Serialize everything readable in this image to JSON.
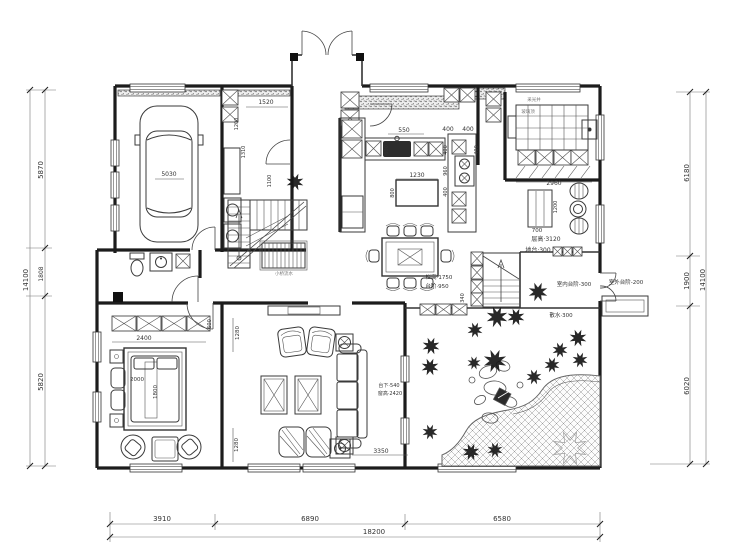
{
  "title": "住宅一层平面布置图",
  "dims": {
    "left": {
      "total": "14100",
      "segments": [
        "5870",
        "1808",
        "5820"
      ]
    },
    "right": {
      "total": "14100",
      "segments": [
        "6180",
        "1900",
        "6020"
      ]
    },
    "bottom": {
      "total": "18200",
      "segments": [
        "3910",
        "6890",
        "6580"
      ]
    }
  },
  "labels": {
    "dim_5870": "5870",
    "dim_1808": "1808",
    "dim_5820": "5820",
    "dim_14100_left": "14100",
    "dim_6180": "6180",
    "dim_1900": "1900",
    "dim_6020": "6020",
    "dim_14100_right": "14100",
    "dim_3910": "3910",
    "dim_6890": "6890",
    "dim_6580": "6580",
    "dim_18200": "18200",
    "garage_car": "5030",
    "pantry_1520": "1520",
    "pantry_1200": "1200",
    "pantry_1310": "1310",
    "pantry_1100": "1100",
    "kitchen_550": "550",
    "kitchen_400a": "400",
    "kitchen_400b": "400",
    "kitchen_600": "600",
    "kitchen_1230": "1230",
    "kitchen_800": "800",
    "kitchen_400c": "400",
    "kitchen_960": "960",
    "kitchen_400d": "400",
    "kitchen_400e": "400",
    "spa_2960": "2960",
    "spa_note1": "采光井",
    "spa_note2": "玻璃顶",
    "tea_1200": "1200",
    "tea_700": "700",
    "note_ceiling": "层高·3120",
    "note_platform": "地台·300",
    "note_apron": "散水·300",
    "stair_rail": "栏高·1750",
    "stair_step": "台阶·950",
    "stair_340": "340",
    "entry_in": "室内台阶-300",
    "entry_out": "室外台阶-200",
    "bridge_note": "小桥流水",
    "bed_2400": "2400",
    "bed_600": "600",
    "bed_2000": "2000",
    "bed_1800": "1800",
    "living_1280a": "1280",
    "living_1280b": "1280",
    "living_3350": "3350",
    "living_sill": "台下·540",
    "living_win": "窗高·2420"
  }
}
